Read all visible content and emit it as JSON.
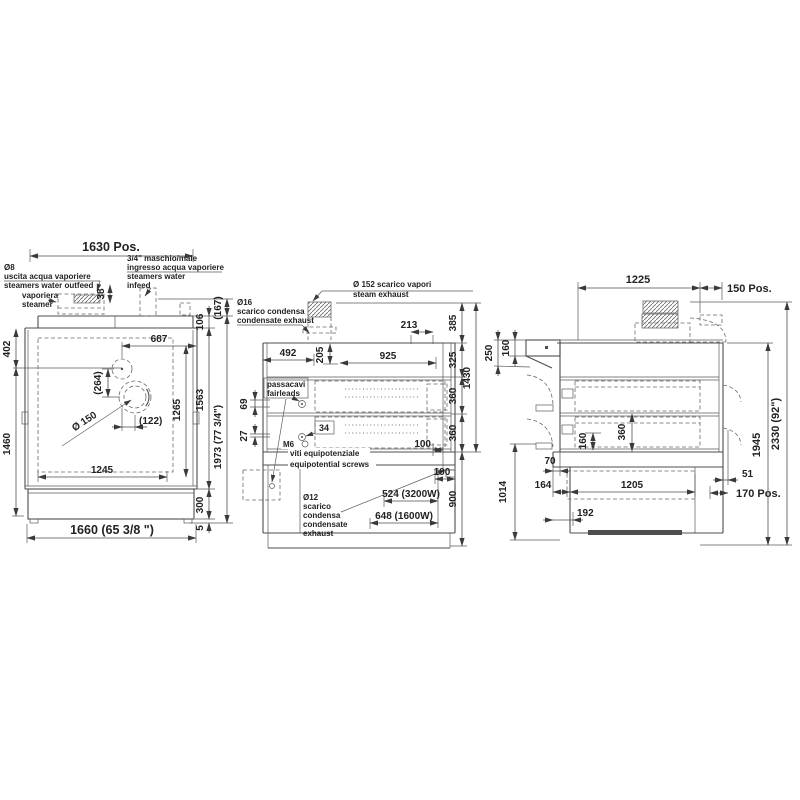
{
  "front": {
    "dim_top": "1630 Pos.",
    "outfeed_l1": "Ø8",
    "outfeed_l2": "uscita acqua vaporiere",
    "outfeed_l3": "steamers water outfeed",
    "steamer_l1": "vaporiera",
    "steamer_l2": "steamer",
    "infeed_l1": "3/4\" maschio/male",
    "infeed_l2": "ingresso acqua vaporiere",
    "infeed_l3": "steamers water",
    "infeed_l4": "infeed",
    "d38": "38",
    "d402": "402",
    "d687": "687",
    "d264": "(264)",
    "d150": "Ø 150",
    "d122": "(122)",
    "d1265": "1265",
    "d1460": "1460",
    "d1245": "1245",
    "d106": "106",
    "d167": "(167)",
    "d1563": "1563",
    "d1973": "1973 (77 3/4\")",
    "d300": "300",
    "d5": "5",
    "d1660": "1660 (65 3/8 \")"
  },
  "back": {
    "steam_l1": "Ø 152 scarico vapori",
    "steam_l2": "steam exhaust",
    "cond16_l1": "Ø16",
    "cond16_l2": "scarico condensa",
    "cond16_l3": "condensate exhaust",
    "fair_l1": "passacavi",
    "fair_l2": "fairleads",
    "m6": "M6",
    "equip_l1": "viti equipotenziale",
    "equip_l2": "equipotential screws",
    "cond12_l1": "Ø12",
    "cond12_l2": "scarico",
    "cond12_l3": "condensa",
    "cond12_l4": "condensate",
    "cond12_l5": "exhaust",
    "d213": "213",
    "d492": "492",
    "d205": "205",
    "d925": "925",
    "d69": "69",
    "d27": "27",
    "d34": "34",
    "d100": "100",
    "d190": "190",
    "d385": "385",
    "d325": "325",
    "d360a": "360",
    "d360b": "360",
    "d1430": "1430",
    "d900": "900",
    "d524": "524 (3200W)",
    "d648": "648 (1600W)"
  },
  "side": {
    "d1225": "1225",
    "d150pos": "150 Pos.",
    "d250": "250",
    "d160a": "160",
    "d160b": "160",
    "d360": "360",
    "d70": "70",
    "d164": "164",
    "d1014": "1014",
    "d1205": "1205",
    "d192": "192",
    "d51": "51",
    "d170pos": "170 Pos.",
    "d1945": "1945",
    "d2330": "2330 (92\")"
  }
}
